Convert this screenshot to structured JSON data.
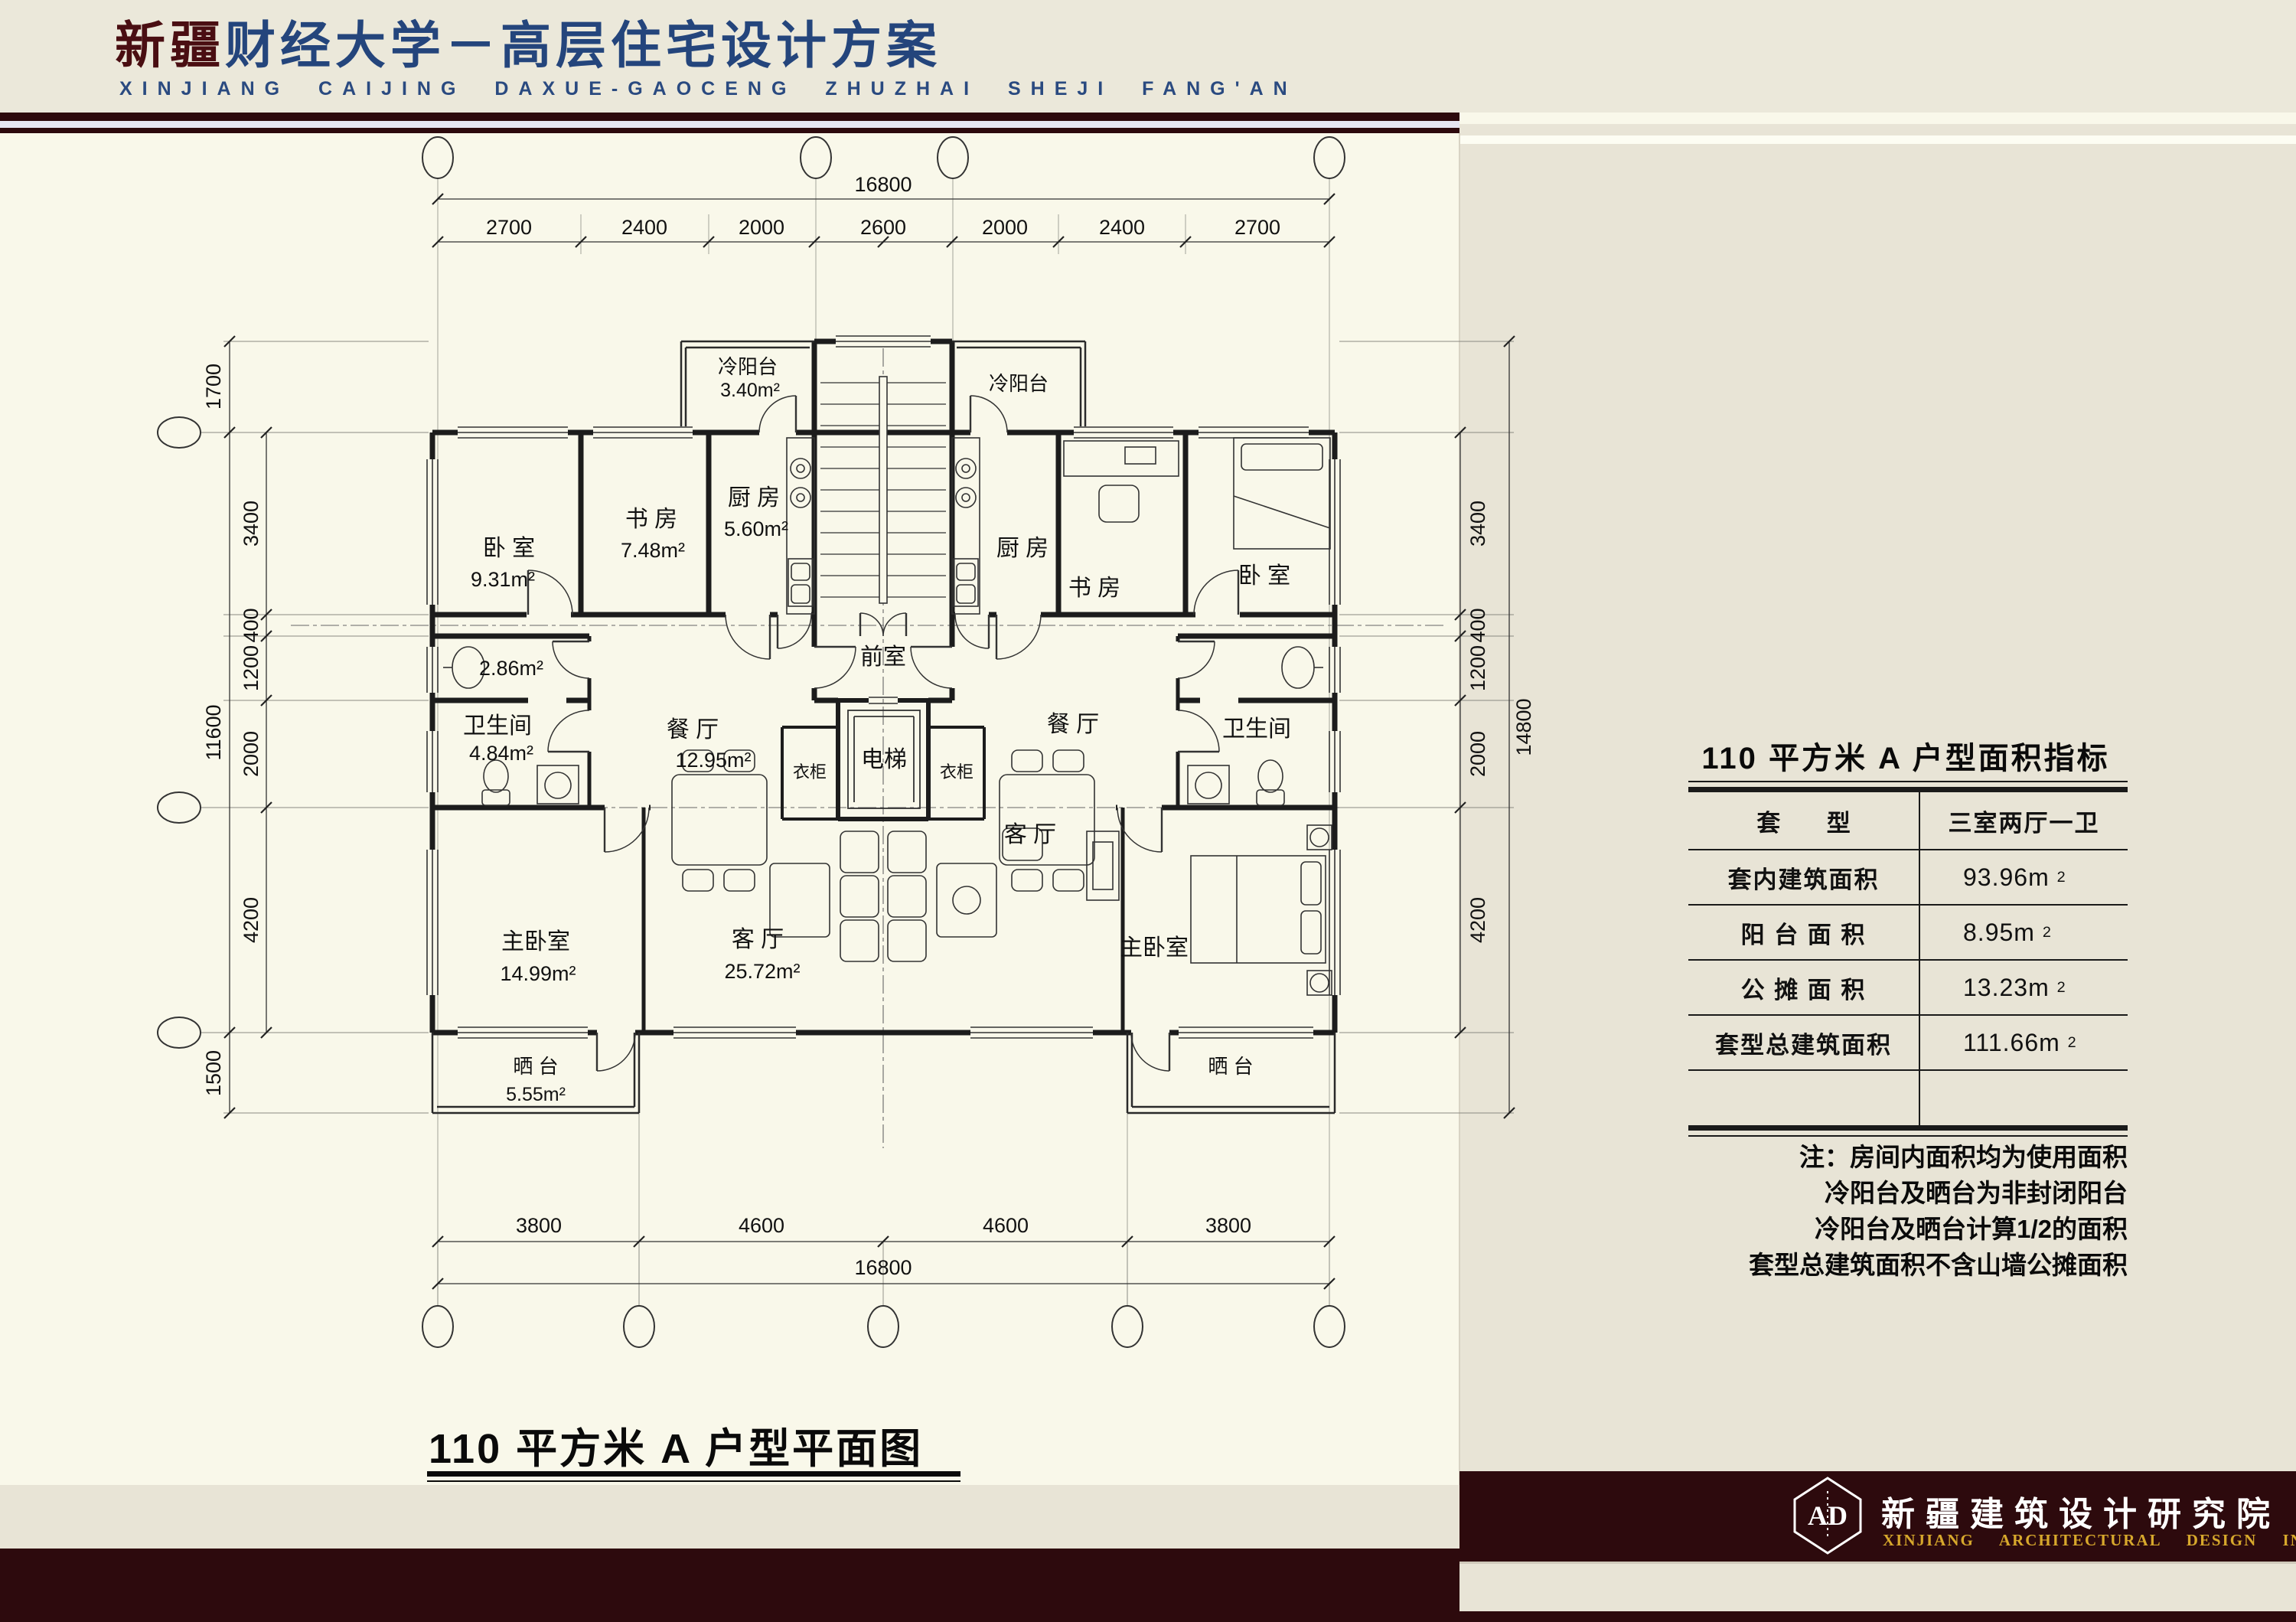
{
  "colors": {
    "maroon": "#2d0a0d",
    "navy": "#24457c",
    "title_red": "#4a0e12",
    "gold": "#d7a82c",
    "cream": "#f9f8ea",
    "beige": "#e8e4d6",
    "lavender": "#e6e6f2"
  },
  "header": {
    "title_em": "新疆",
    "title_rest": "财经大学－高层住宅设计方案",
    "subtitle": "XINJIANG CAIJING DAXUE-GAOCENG ZHUZHAI SHEJI FANG'AN"
  },
  "plan": {
    "caption": "110 平方米 A 户型平面图",
    "rooms": {
      "bedroom_l": "卧 室",
      "bedroom_l_area": "9.31m²",
      "study_l": "书 房",
      "study_l_area": "7.48m²",
      "kitchen_l": "厨 房",
      "kitchen_l_area": "5.60m²",
      "cold_balcony_l": "冷阳台",
      "cold_balcony_l_area": "3.40m²",
      "wash_l_area": "2.86m²",
      "bath_l": "卫生间",
      "bath_l_area": "4.84m²",
      "dining_l": "餐 厅",
      "dining_l_area": "12.95m²",
      "master_l": "主卧室",
      "master_l_area": "14.99m²",
      "living_l": "客 厅",
      "living_l_area": "25.72m²",
      "terrace_l": "晒 台",
      "terrace_l_area": "5.55m²",
      "wardrobe_l": "衣柜",
      "wardrobe_r": "衣柜",
      "vestibule": "前室",
      "elevator": "电梯",
      "cold_balcony_r": "冷阳台",
      "kitchen_r": "厨 房",
      "study_r": "书 房",
      "bedroom_r": "卧 室",
      "dining_r": "餐 厅",
      "bath_r": "卫生间",
      "living_r": "客 厅",
      "master_r": "主卧室",
      "terrace_r": "晒 台"
    },
    "dims": {
      "top_total": "16800",
      "top_segs": [
        "2700",
        "2400",
        "2000",
        "2600",
        "2000",
        "2400",
        "2700"
      ],
      "bottom_total": "16800",
      "bottom_segs": [
        "3800",
        "4600",
        "4600",
        "3800"
      ],
      "left_total": "11600",
      "left_outer_top": "1700",
      "left_outer_bottom": "1500",
      "left_segs": [
        "3400",
        "400",
        "1200",
        "2000",
        "4200"
      ],
      "right_total": "14800",
      "right_segs": [
        "3400",
        "400",
        "1200",
        "2000",
        "4200"
      ]
    }
  },
  "panel": {
    "table_title": "110 平方米 A 户型面积指标",
    "table": {
      "header_label": "套 型",
      "header_value": "三室两厅一卫",
      "rows": [
        {
          "label": "套内建筑面积",
          "value": "93.96m",
          "sup": "2"
        },
        {
          "label": "阳 台 面 积",
          "value": "8.95m",
          "sup": "2"
        },
        {
          "label": "公 摊 面 积",
          "value": "13.23m",
          "sup": "2"
        },
        {
          "label": "套型总建筑面积",
          "value": "111.66m",
          "sup": "2"
        }
      ]
    },
    "notes": [
      "注：房间内面积均为使用面积",
      "冷阳台及晒台为非封闭阳台",
      "冷阳台及晒台计算1/2的面积",
      "套型总建筑面积不含山墙公摊面积"
    ]
  },
  "footer": {
    "cn": "新疆建筑设计研究院",
    "en": "XINJIANG ARCHITECTURAL DESIGN INSTITUTE",
    "logo_monogram": "AD"
  }
}
